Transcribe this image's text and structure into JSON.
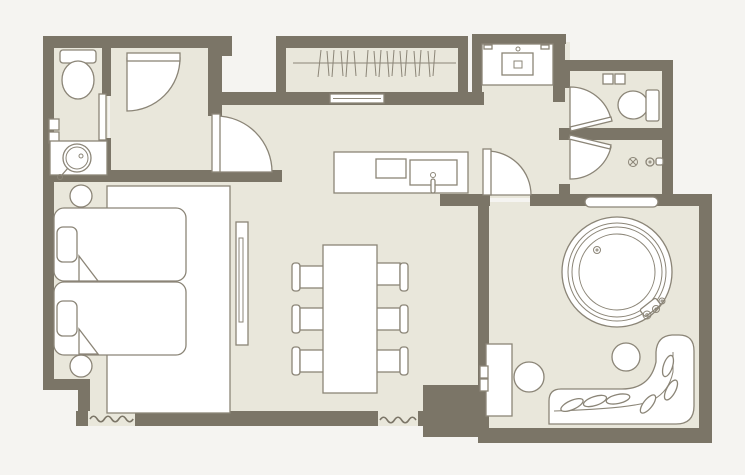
{
  "page": {
    "image_type": "floor-plan"
  },
  "colors": {
    "background": "#f5f4f1",
    "floor": "#e9e7db",
    "wall": "#7b7567",
    "outline": "#8b8577",
    "furniture": "#ffffff"
  },
  "legend": {
    "fixtures": [
      "toilet",
      "round-wash-basin",
      "entry-closet-door",
      "hall-door",
      "wardrobe-rail-with-hangers",
      "wardrobe-sliding-door",
      "vanity-counter-sink",
      "corridor-door",
      "wc-door",
      "shower-door",
      "second-toilet",
      "shower-drain",
      "shower-mixer",
      "kitchen-island",
      "cooktop",
      "island-sink",
      "island-faucet",
      "twin-bed",
      "pillow",
      "turned-sheet-fold",
      "nightstand",
      "bed-rug",
      "tv-board",
      "dining-table",
      "dining-chair",
      "window-shelf",
      "round-jacuzzi-tub",
      "tub-faucet",
      "console-cabinet",
      "round-stool",
      "lounge-sofa",
      "leaf-cushion",
      "wall-break-squiggle"
    ],
    "counts": {
      "beds": 2,
      "dining_chairs": 6,
      "swing_doors": 6,
      "toilets": 2,
      "round_stools": 2
    }
  }
}
